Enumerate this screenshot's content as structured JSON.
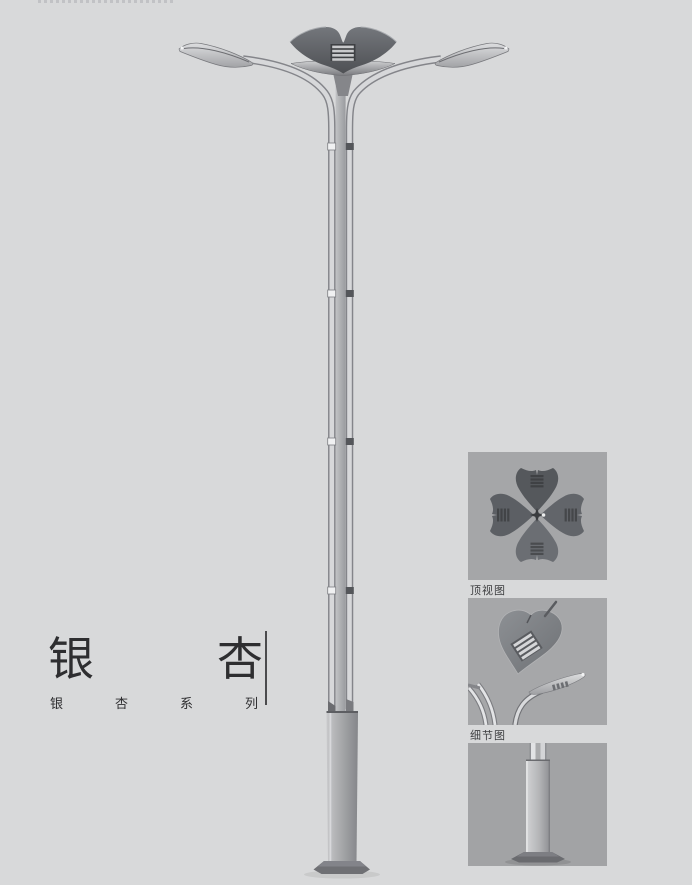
{
  "page": {
    "background_color": "#d8d9da",
    "panel_background_color": "#a5a6a8",
    "text_color": "#2e2e30"
  },
  "product": {
    "title": "银杏",
    "title_chars": [
      "银",
      "杏"
    ],
    "series": "银杏系列",
    "series_chars": [
      "银",
      "杏",
      "系",
      "列"
    ]
  },
  "views": [
    {
      "id": "top-view",
      "label": "顶视图"
    },
    {
      "id": "detail-view",
      "label": "细节图"
    },
    {
      "id": "base-view"
    }
  ]
}
